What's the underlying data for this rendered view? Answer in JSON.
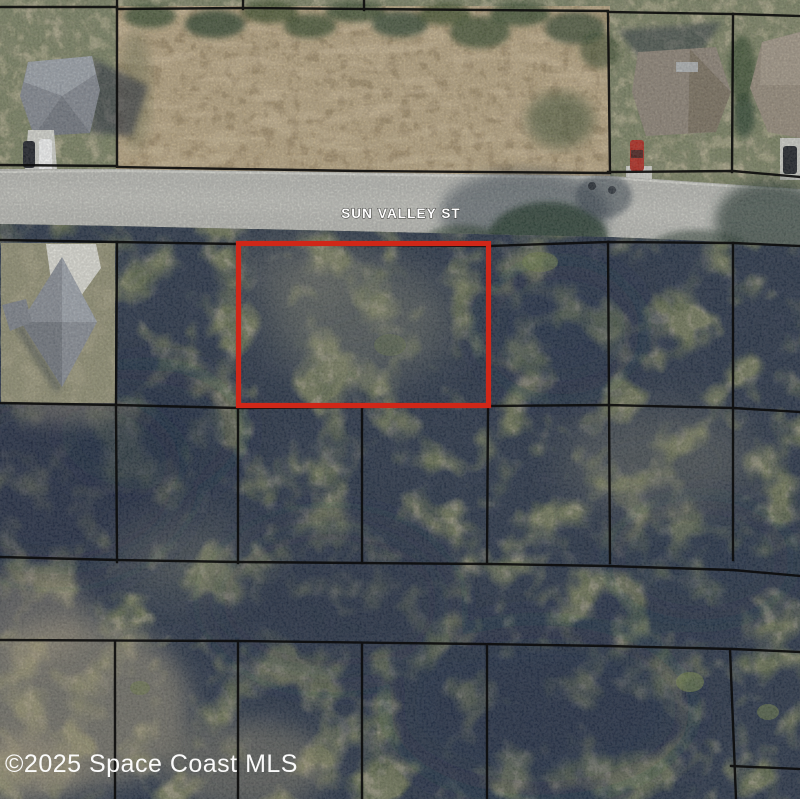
{
  "street": {
    "label": "SUN VALLEY ST"
  },
  "watermark": {
    "text": "©2025 Space Coast MLS"
  },
  "colors": {
    "highlight_red": "#d02718",
    "parcel_line": "#0d0d0d",
    "road_gray": "#b5b6b1",
    "street_label_fill": "#ffffff",
    "watermark_fill": "#ffffff"
  }
}
